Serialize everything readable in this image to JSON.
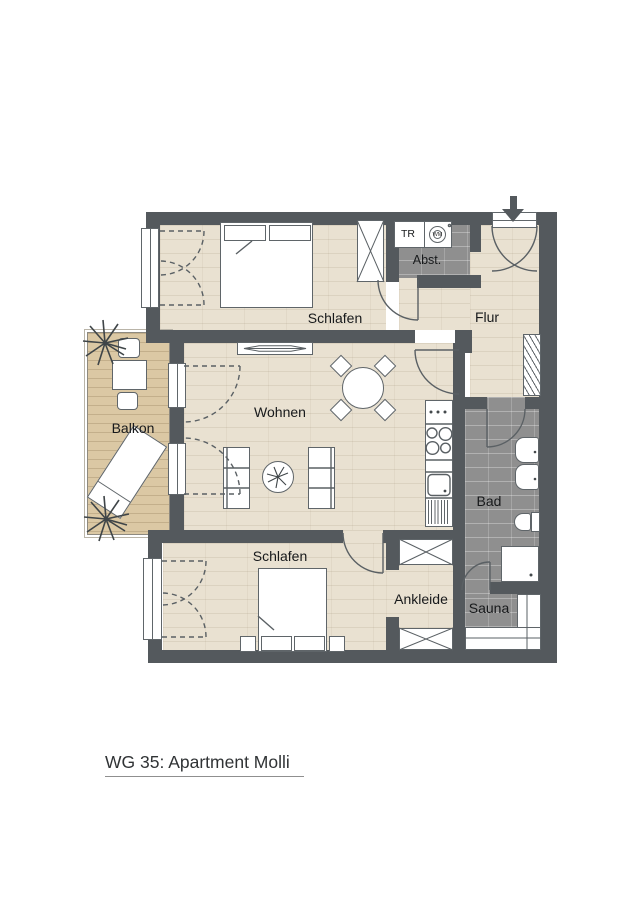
{
  "title": "WG 35: Apartment Molli",
  "rooms": {
    "schlafen_top": "Schlafen",
    "abstellraum": "Abst.",
    "flur": "Flur",
    "balkon": "Balkon",
    "wohnen": "Wohnen",
    "bad": "Bad",
    "schlafen_bottom": "Schlafen",
    "ankleide": "Ankleide",
    "sauna": "Sauna"
  },
  "appliances": {
    "dryer": "TR",
    "washer": "WM"
  },
  "colors": {
    "wall": "#54595d",
    "wood_floor": "#e9e1d1",
    "balcony_floor": "#dbc8a4",
    "tile_floor": "#8f8f8f",
    "linework": "#5a6064",
    "text": "#17191b"
  }
}
